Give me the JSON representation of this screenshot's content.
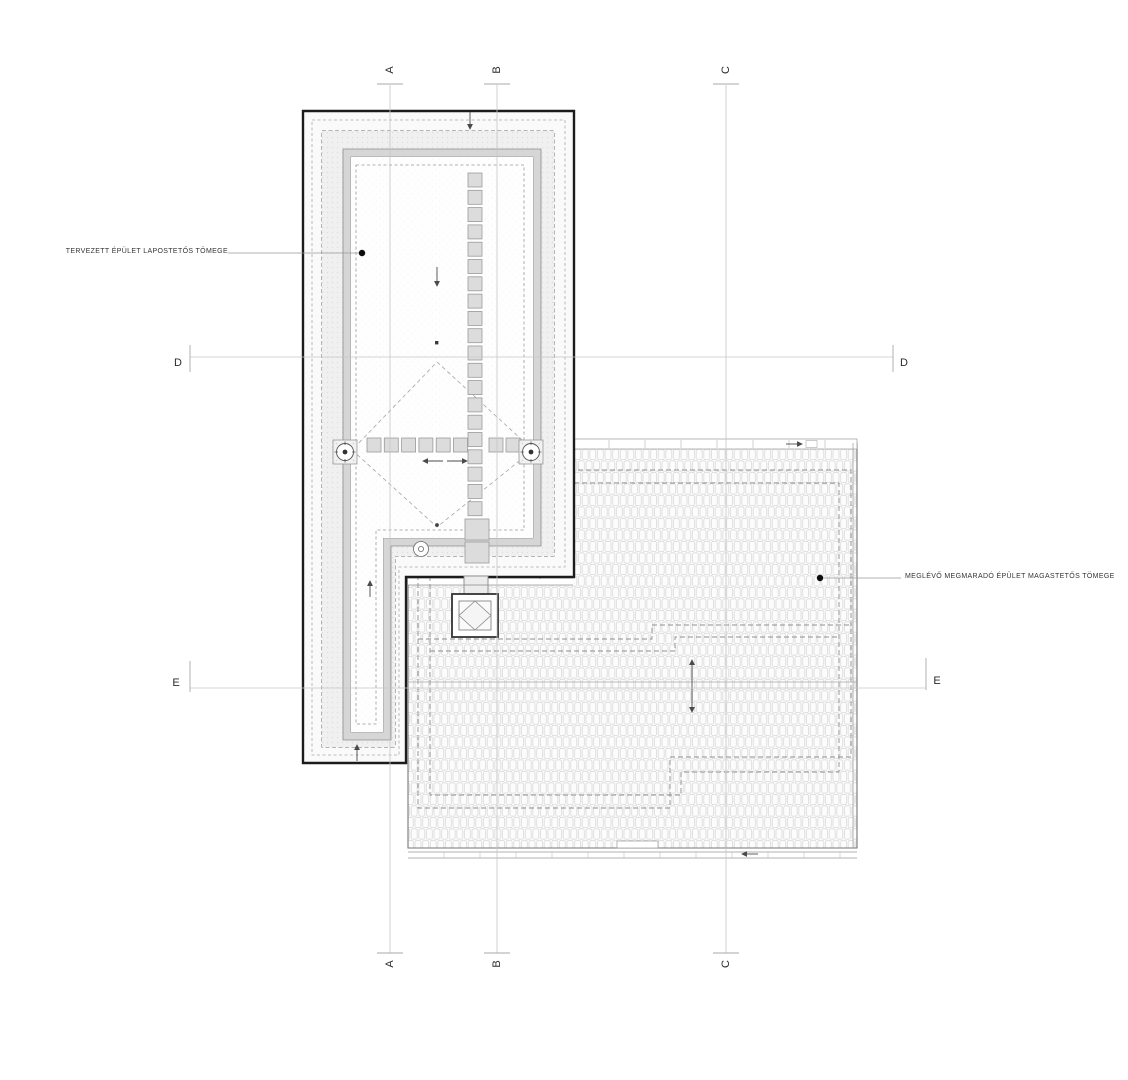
{
  "annotations": {
    "flat_roof_label": "TERVEZETT ÉPÜLET LAPOSTETŐS TÖMEGE",
    "pitched_roof_label": "MEGLÉVŐ MEGMARADÓ ÉPÜLET MAGASTETŐS TÖMEGE"
  },
  "section_markers": {
    "a": "A",
    "b": "B",
    "c": "C",
    "d": "D",
    "e": "E"
  },
  "colors": {
    "building_outline": "#1c1c1c",
    "parapet_band": "#d6d6d6",
    "paver_fill": "#dcdcdc",
    "tile_line": "#d9d9d9",
    "dashed_line": "#8f8f8f",
    "section_line": "#c6c6c6",
    "marker_text": "#2b2b2b",
    "annotation_text": "#333333"
  }
}
